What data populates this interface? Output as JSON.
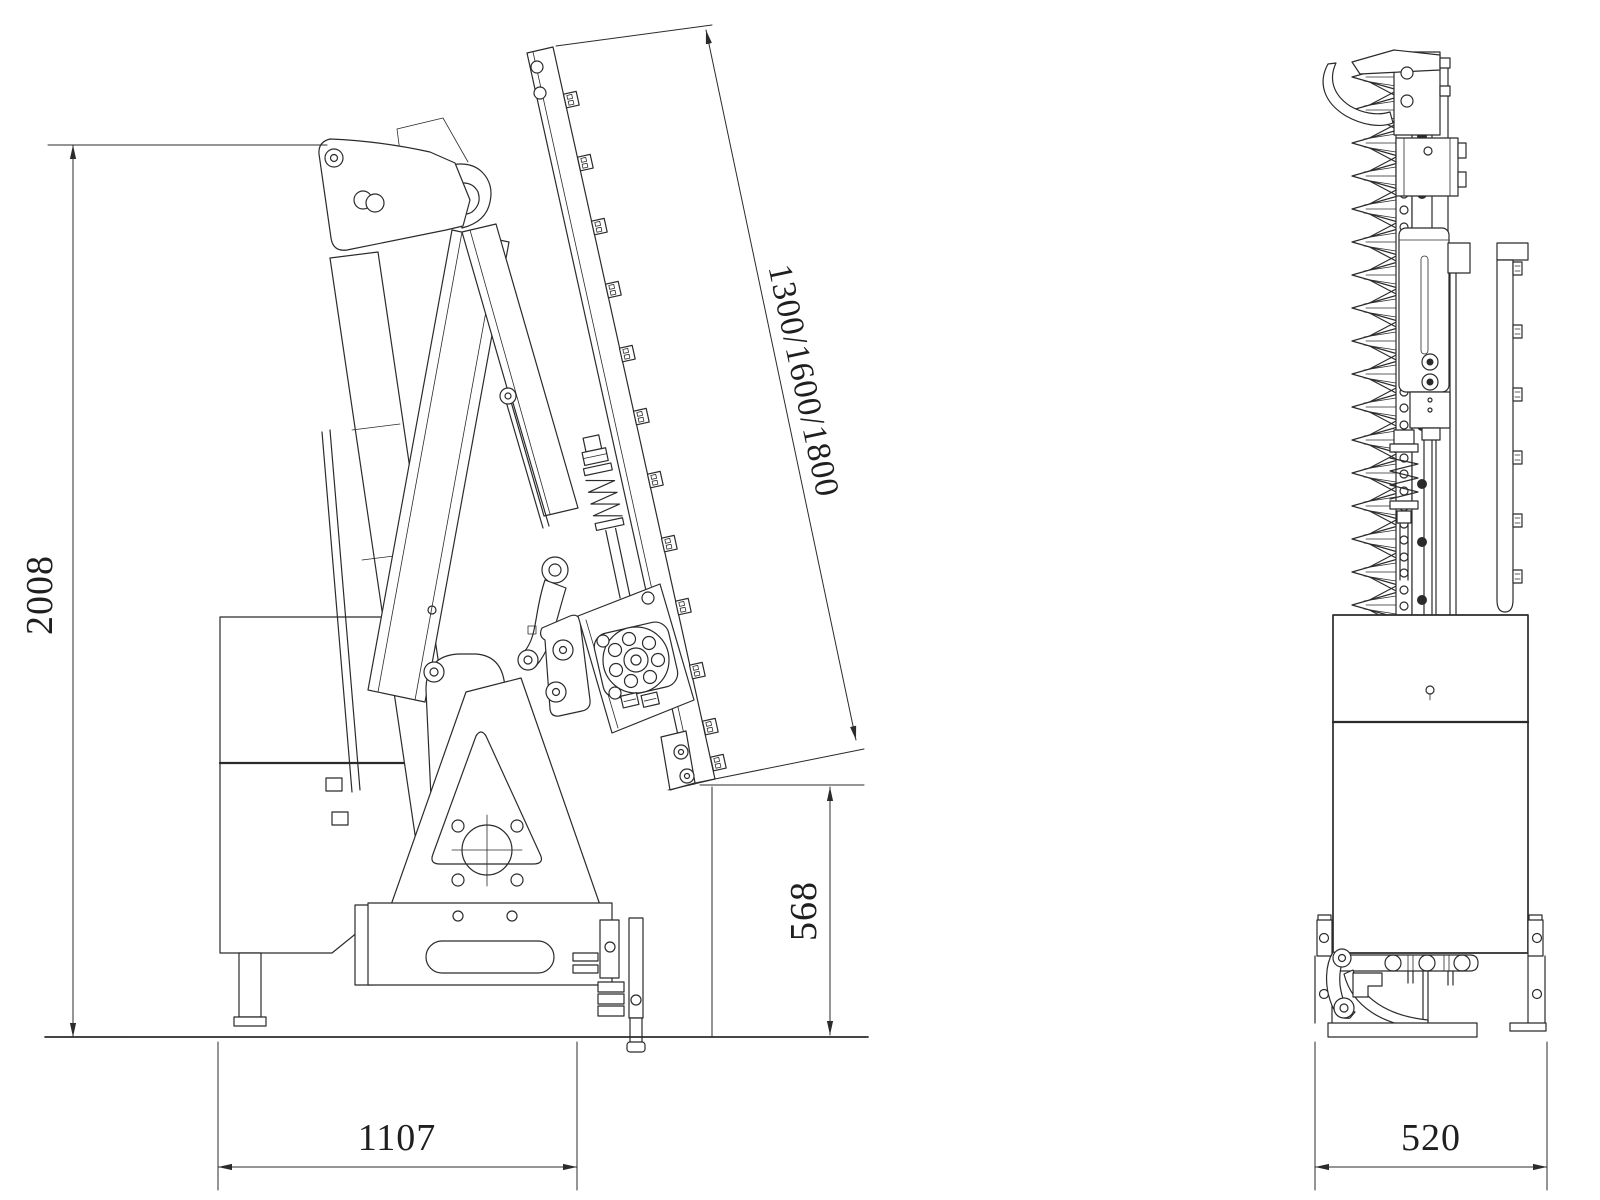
{
  "page": {
    "background": "#ffffff",
    "line_color": "#2b2b2b",
    "text_color": "#1f1f1f"
  },
  "dimensions": {
    "overall_height": "2008",
    "base_width": "1107",
    "cutter_tip_height": "568",
    "cutter_bar_length_options": "1300/1600/1800",
    "front_width": "520"
  }
}
